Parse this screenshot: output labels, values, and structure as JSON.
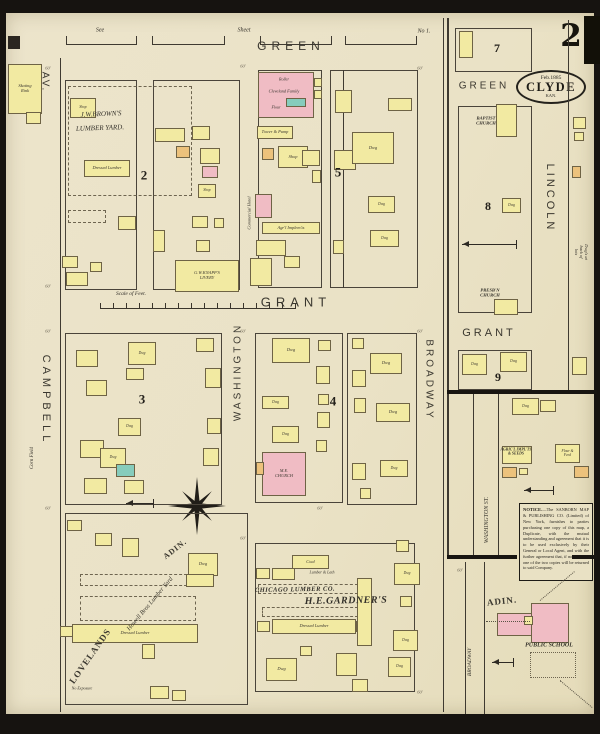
{
  "title": "Sanborn map, Clyde Kansas, Sheet 2",
  "corner": {
    "sheet_number": "2"
  },
  "stamp": {
    "date": "Feb.1885",
    "city": "CLYDE",
    "state": "KAN."
  },
  "notice": {
    "title": "NOTICE.",
    "body": "—The SANBORN MAP & PUBLISHING CO. (Limited) of New York, furnishes to parties purchasing one copy of this map, a Duplicate, with the mutual understanding and agreement that it is to be used exclusively by their General or Local Agent, and with the further agreement that, if not so used, one of the two copies will be returned to said Company."
  },
  "colors": {
    "paper": "#ebe3c8",
    "frame": "#161310",
    "line": "#3f3a31",
    "yellow": "#f2eaa2",
    "pink": "#f0bcc4",
    "teal": "#86ccbc",
    "orange": "#ecc27c",
    "mill_line": "#b86a78"
  },
  "streets": [
    {
      "t": "GREEN",
      "x": 291,
      "y": 46,
      "s": 12,
      "r": 0,
      "ls": 5,
      "f": "s"
    },
    {
      "t": "GRANT",
      "x": 296,
      "y": 302,
      "s": 13,
      "r": 0,
      "ls": 5,
      "f": "s"
    },
    {
      "t": "CAMPBELL",
      "x": 46,
      "y": 400,
      "s": 11,
      "r": 90,
      "ls": 4,
      "f": "s"
    },
    {
      "t": "AV.",
      "x": 45,
      "y": 82,
      "s": 10,
      "r": 90,
      "ls": 2,
      "f": "s"
    },
    {
      "t": "WASHINGTON",
      "x": 238,
      "y": 372,
      "s": 10,
      "r": -90,
      "ls": 3,
      "f": "s"
    },
    {
      "t": "BROADWAY",
      "x": 429,
      "y": 380,
      "s": 10,
      "r": 90,
      "ls": 3,
      "f": "s"
    },
    {
      "t": "LINCOLN",
      "x": 550,
      "y": 198,
      "s": 11,
      "r": 90,
      "ls": 3,
      "f": "s"
    },
    {
      "t": "GREEN",
      "x": 484,
      "y": 86,
      "s": 10,
      "r": 0,
      "ls": 3,
      "f": "s"
    },
    {
      "t": "GRANT",
      "x": 489,
      "y": 333,
      "s": 11,
      "r": 0,
      "ls": 3,
      "f": "s"
    },
    {
      "t": "WASHINGTON ST.",
      "x": 487,
      "y": 520,
      "s": 6,
      "r": -90,
      "ls": 0,
      "f": "i"
    },
    {
      "t": "BROADWAY",
      "x": 470,
      "y": 662,
      "s": 5.5,
      "r": -90,
      "ls": 0,
      "f": "i"
    },
    {
      "t": "ADIN.",
      "x": 175,
      "y": 549,
      "s": 8,
      "r": -38,
      "ls": 1,
      "f": "f"
    },
    {
      "t": "LOVELANDS",
      "x": 90,
      "y": 656,
      "s": 9,
      "r": -55,
      "ls": 1,
      "f": "f"
    },
    {
      "t": "ADIN.",
      "x": 502,
      "y": 601,
      "s": 9,
      "r": -6,
      "ls": 1,
      "f": "f"
    },
    {
      "t": "Howell Bros Lumber Yard",
      "x": 150,
      "y": 604,
      "s": 6.5,
      "r": -50,
      "ls": 0,
      "f": "i"
    }
  ],
  "labels": [
    {
      "t": "See",
      "x": 100,
      "y": 31,
      "s": 6,
      "st": "i",
      "r": 0
    },
    {
      "t": "Sheet",
      "x": 244,
      "y": 31,
      "s": 6,
      "st": "i",
      "r": 0
    },
    {
      "t": "No 1.",
      "x": 424,
      "y": 32,
      "s": 6,
      "st": "i",
      "r": 0
    },
    {
      "t": "J.W.BROWN'S",
      "x": 101,
      "y": 114,
      "s": 7,
      "st": "i",
      "r": -2
    },
    {
      "t": "LUMBER YARD.",
      "x": 100,
      "y": 128,
      "s": 7,
      "st": "i",
      "r": -2
    },
    {
      "t": "Scale of Feet.",
      "x": 131,
      "y": 294,
      "s": 5.5,
      "st": "i",
      "r": 0
    },
    {
      "t": "Roller",
      "x": 284,
      "y": 80,
      "s": 4,
      "st": "i",
      "r": 0
    },
    {
      "t": "Cleveland Family",
      "x": 284,
      "y": 92,
      "s": 4.3,
      "st": "i",
      "r": 0
    },
    {
      "t": "Flour",
      "x": 276,
      "y": 108,
      "s": 4,
      "st": "i",
      "r": 0
    },
    {
      "t": "Commercial Hotel",
      "x": 249,
      "y": 213,
      "s": 4.5,
      "st": "i",
      "r": -90
    },
    {
      "t": "CHICAGO LUMBER CO.",
      "x": 295,
      "y": 590,
      "s": 6.5,
      "st": "bi",
      "r": -1
    },
    {
      "t": "H.E.GARDNER'S",
      "x": 346,
      "y": 601,
      "s": 10,
      "st": "bi",
      "r": -1
    },
    {
      "t": "Lumber & Lath",
      "x": 322,
      "y": 573,
      "s": 4,
      "st": "i",
      "r": 0
    },
    {
      "t": "BAPTIST\nCHURCH",
      "x": 486,
      "y": 121,
      "s": 4.6,
      "st": "b",
      "r": 0
    },
    {
      "t": "PRESB'N\nCHURCH",
      "x": 490,
      "y": 293,
      "s": 4.6,
      "st": "b",
      "r": 0
    },
    {
      "t": "PUBLIC SCHOOL",
      "x": 549,
      "y": 646,
      "s": 6,
      "st": "b",
      "r": 0
    },
    {
      "t": "No Exposure",
      "x": 82,
      "y": 689,
      "s": 4,
      "st": "i",
      "r": 0
    },
    {
      "t": "AGRIC'L IMPL'TS\n& SEEDS",
      "x": 516,
      "y": 452,
      "s": 3.8,
      "st": "b",
      "r": 0
    },
    {
      "t": "Dwg's at back of lots",
      "x": 581,
      "y": 252,
      "s": 4.5,
      "st": "i",
      "r": 90
    },
    {
      "t": "Corn Field",
      "x": 33,
      "y": 458,
      "s": 5,
      "st": "i",
      "r": -90
    }
  ],
  "dims": {
    "t": "60'",
    "pts": [
      [
        48,
        68
      ],
      [
        243,
        66
      ],
      [
        420,
        68
      ],
      [
        48,
        286
      ],
      [
        48,
        331
      ],
      [
        243,
        331
      ],
      [
        420,
        331
      ],
      [
        48,
        508
      ],
      [
        320,
        508
      ],
      [
        460,
        570
      ],
      [
        243,
        538
      ],
      [
        420,
        692
      ]
    ]
  },
  "block_numbers": [
    {
      "t": "2",
      "x": 144,
      "y": 176,
      "s": 13
    },
    {
      "t": "5",
      "x": 338,
      "y": 173,
      "s": 13
    },
    {
      "t": "3",
      "x": 142,
      "y": 400,
      "s": 13
    },
    {
      "t": "4",
      "x": 333,
      "y": 402,
      "s": 13
    },
    {
      "t": "7",
      "x": 497,
      "y": 49,
      "s": 12
    },
    {
      "t": "8",
      "x": 488,
      "y": 207,
      "s": 12
    },
    {
      "t": "9",
      "x": 498,
      "y": 378,
      "s": 12
    }
  ],
  "blocks": [
    [
      65,
      80,
      72,
      210
    ],
    [
      153,
      80,
      87,
      210
    ],
    [
      258,
      70,
      64,
      218
    ],
    [
      330,
      70,
      88,
      218
    ],
    [
      65,
      333,
      157,
      172
    ],
    [
      255,
      333,
      88,
      170
    ],
    [
      347,
      333,
      70,
      172
    ],
    [
      65,
      513,
      183,
      192
    ],
    [
      255,
      543,
      160,
      149
    ],
    [
      455,
      28,
      77,
      44
    ],
    [
      458,
      106,
      74,
      207
    ],
    [
      458,
      350,
      74,
      40
    ]
  ],
  "lines": [
    [
      60,
      58,
      1,
      654,
      "n"
    ],
    [
      443,
      18,
      1,
      694,
      "n"
    ],
    [
      447,
      18,
      2,
      538,
      "n"
    ],
    [
      568,
      20,
      1,
      370,
      "n"
    ],
    [
      473,
      392,
      1,
      164,
      "n"
    ],
    [
      498,
      392,
      1,
      164,
      "n"
    ],
    [
      465,
      562,
      1,
      152,
      "n"
    ],
    [
      484,
      562,
      1,
      152,
      "n"
    ],
    [
      343,
      70,
      1,
      218,
      "n"
    ],
    [
      259,
      87,
      54,
      1,
      "m"
    ],
    [
      259,
      101,
      54,
      1,
      "m"
    ]
  ],
  "thick_lines": [
    [
      447,
      390,
      150,
      4
    ],
    [
      447,
      555,
      70,
      4
    ],
    [
      572,
      555,
      25,
      4
    ]
  ],
  "staples": [
    {
      "x": 66,
      "w": 69
    },
    {
      "x": 152,
      "w": 71
    },
    {
      "x": 260,
      "w": 70
    },
    {
      "x": 345,
      "w": 70
    }
  ],
  "dashed": [
    [
      68,
      86,
      124,
      110,
      "dashed"
    ],
    [
      68,
      210,
      38,
      13,
      "dashed"
    ],
    [
      80,
      574,
      112,
      12,
      "dashed"
    ],
    [
      80,
      596,
      116,
      25,
      "dashed"
    ],
    [
      258,
      584,
      100,
      10,
      "dashed"
    ],
    [
      262,
      607,
      96,
      10,
      "dashed"
    ],
    [
      530,
      652,
      46,
      26,
      "dotted"
    ]
  ],
  "buildings": [
    [
      8,
      64,
      34,
      50,
      "y",
      "Skating\nRink",
      0
    ],
    [
      26,
      112,
      15,
      12,
      "y",
      "",
      0
    ],
    [
      70,
      98,
      26,
      20,
      "y",
      "Shop",
      0
    ],
    [
      84,
      160,
      46,
      17,
      "y",
      "Dressed Lumber",
      0
    ],
    [
      118,
      216,
      18,
      14,
      "y",
      "",
      1
    ],
    [
      155,
      128,
      30,
      14,
      "y",
      "",
      0
    ],
    [
      192,
      126,
      18,
      14,
      "y",
      "",
      0
    ],
    [
      176,
      146,
      14,
      12,
      "o",
      "",
      0
    ],
    [
      200,
      148,
      20,
      16,
      "y",
      "",
      0
    ],
    [
      202,
      166,
      16,
      12,
      "p",
      "",
      0
    ],
    [
      198,
      184,
      18,
      14,
      "y",
      "Shop",
      0
    ],
    [
      153,
      230,
      12,
      22,
      "y",
      "",
      1
    ],
    [
      192,
      216,
      16,
      12,
      "y",
      "",
      0
    ],
    [
      214,
      218,
      10,
      10,
      "y",
      "",
      0
    ],
    [
      175,
      260,
      64,
      32,
      "y",
      "G.W.KNAPP'S\nLIVERY",
      1
    ],
    [
      62,
      256,
      16,
      12,
      "y",
      "",
      0
    ],
    [
      66,
      272,
      22,
      14,
      "y",
      "",
      0
    ],
    [
      90,
      262,
      12,
      10,
      "y",
      "",
      0
    ],
    [
      196,
      240,
      14,
      12,
      "y",
      "",
      0
    ],
    [
      258,
      72,
      56,
      46,
      "p",
      "",
      0
    ],
    [
      286,
      98,
      20,
      9,
      "t",
      "",
      0
    ],
    [
      314,
      78,
      8,
      9,
      "y",
      "",
      0
    ],
    [
      314,
      90,
      8,
      9,
      "y",
      "",
      0
    ],
    [
      257,
      126,
      36,
      13,
      "y",
      "Tower & Pump",
      0
    ],
    [
      278,
      146,
      30,
      22,
      "y",
      "Shop",
      0
    ],
    [
      302,
      150,
      18,
      16,
      "y",
      "",
      0
    ],
    [
      262,
      148,
      12,
      12,
      "o",
      "",
      0
    ],
    [
      255,
      194,
      17,
      24,
      "p",
      "",
      0
    ],
    [
      262,
      222,
      58,
      12,
      "y",
      "Agr'l Implem'ts",
      0
    ],
    [
      256,
      240,
      30,
      16,
      "y",
      "",
      0
    ],
    [
      250,
      258,
      22,
      28,
      "y",
      "",
      0
    ],
    [
      284,
      256,
      16,
      12,
      "y",
      "",
      0
    ],
    [
      312,
      170,
      9,
      13,
      "y",
      "",
      1
    ],
    [
      335,
      90,
      17,
      23,
      "y",
      "",
      1
    ],
    [
      334,
      150,
      22,
      20,
      "y",
      "",
      1
    ],
    [
      352,
      132,
      42,
      32,
      "y",
      "Dwg",
      0
    ],
    [
      368,
      196,
      27,
      17,
      "y",
      "Dwg",
      0
    ],
    [
      370,
      230,
      29,
      17,
      "y",
      "Dwg",
      0
    ],
    [
      388,
      98,
      24,
      13,
      "y",
      "",
      0
    ],
    [
      333,
      240,
      11,
      14,
      "y",
      "",
      0
    ],
    [
      76,
      350,
      22,
      17,
      "y",
      "",
      0
    ],
    [
      128,
      342,
      28,
      23,
      "y",
      "Dwg",
      0
    ],
    [
      126,
      368,
      18,
      12,
      "y",
      "",
      0
    ],
    [
      86,
      380,
      21,
      16,
      "y",
      "",
      0
    ],
    [
      118,
      418,
      23,
      18,
      "y",
      "Dwg",
      0
    ],
    [
      80,
      440,
      24,
      18,
      "y",
      "",
      0
    ],
    [
      100,
      448,
      26,
      20,
      "y",
      "Dwg",
      0
    ],
    [
      84,
      478,
      23,
      16,
      "y",
      "",
      0
    ],
    [
      124,
      480,
      20,
      14,
      "y",
      "",
      0
    ],
    [
      116,
      464,
      19,
      13,
      "t",
      "",
      0
    ],
    [
      205,
      368,
      16,
      20,
      "y",
      "",
      1
    ],
    [
      207,
      418,
      14,
      16,
      "y",
      "",
      1
    ],
    [
      203,
      448,
      16,
      18,
      "y",
      "",
      1
    ],
    [
      196,
      338,
      18,
      14,
      "y",
      "",
      0
    ],
    [
      272,
      338,
      38,
      25,
      "y",
      "Dwg",
      0
    ],
    [
      262,
      396,
      27,
      13,
      "y",
      "Dwg",
      0
    ],
    [
      272,
      426,
      27,
      17,
      "y",
      "Dwg",
      0
    ],
    [
      262,
      452,
      44,
      44,
      "p",
      "M.E.\nCHURCH",
      0
    ],
    [
      256,
      462,
      8,
      13,
      "o",
      "",
      0
    ],
    [
      318,
      340,
      13,
      11,
      "y",
      "",
      0
    ],
    [
      316,
      366,
      14,
      18,
      "y",
      "",
      1
    ],
    [
      318,
      394,
      11,
      11,
      "y",
      "",
      0
    ],
    [
      317,
      412,
      13,
      16,
      "y",
      "",
      1
    ],
    [
      316,
      440,
      11,
      12,
      "y",
      "",
      0
    ],
    [
      370,
      353,
      32,
      21,
      "y",
      "Dwg",
      0
    ],
    [
      376,
      403,
      34,
      19,
      "y",
      "Dwg",
      0
    ],
    [
      380,
      460,
      28,
      17,
      "y",
      "Dwg",
      0
    ],
    [
      352,
      370,
      14,
      17,
      "y",
      "",
      1
    ],
    [
      352,
      463,
      14,
      17,
      "y",
      "",
      1
    ],
    [
      354,
      398,
      12,
      15,
      "y",
      "",
      0
    ],
    [
      352,
      338,
      12,
      11,
      "y",
      "",
      0
    ],
    [
      360,
      488,
      11,
      11,
      "y",
      "",
      0
    ],
    [
      67,
      520,
      15,
      11,
      "y",
      "",
      0
    ],
    [
      95,
      533,
      17,
      13,
      "y",
      "",
      0
    ],
    [
      122,
      538,
      17,
      19,
      "y",
      "",
      1
    ],
    [
      188,
      553,
      30,
      23,
      "y",
      "Dwg",
      0
    ],
    [
      186,
      574,
      28,
      13,
      "y",
      "",
      0
    ],
    [
      72,
      624,
      126,
      19,
      "y",
      "Dressed Lumber",
      0
    ],
    [
      60,
      626,
      13,
      11,
      "y",
      "",
      0
    ],
    [
      142,
      644,
      13,
      15,
      "y",
      "",
      1
    ],
    [
      150,
      686,
      19,
      13,
      "y",
      "",
      0
    ],
    [
      172,
      690,
      14,
      11,
      "y",
      "",
      0
    ],
    [
      292,
      555,
      37,
      14,
      "y",
      "Coal",
      0
    ],
    [
      256,
      568,
      14,
      11,
      "y",
      "",
      0
    ],
    [
      272,
      568,
      23,
      12,
      "y",
      "",
      0
    ],
    [
      272,
      619,
      84,
      15,
      "y",
      "Dressed Lumber",
      0
    ],
    [
      257,
      621,
      13,
      11,
      "y",
      "",
      0
    ],
    [
      356,
      621,
      15,
      11,
      "y",
      "",
      0
    ],
    [
      357,
      578,
      15,
      68,
      "y",
      "",
      1
    ],
    [
      396,
      540,
      13,
      12,
      "y",
      "",
      0
    ],
    [
      394,
      563,
      26,
      22,
      "y",
      "Dwg",
      0
    ],
    [
      400,
      596,
      12,
      11,
      "y",
      "",
      0
    ],
    [
      393,
      630,
      25,
      21,
      "y",
      "Dwg",
      0
    ],
    [
      266,
      658,
      31,
      23,
      "y",
      "Dwg",
      0
    ],
    [
      336,
      653,
      21,
      23,
      "y",
      "",
      1
    ],
    [
      352,
      679,
      16,
      13,
      "y",
      "",
      1
    ],
    [
      388,
      657,
      23,
      20,
      "y",
      "Dwg",
      0
    ],
    [
      300,
      646,
      12,
      10,
      "y",
      "",
      0
    ],
    [
      459,
      31,
      14,
      27,
      "y",
      "",
      1
    ],
    [
      496,
      104,
      21,
      33,
      "y",
      "",
      0
    ],
    [
      502,
      198,
      19,
      15,
      "y",
      "Dwg",
      0
    ],
    [
      494,
      299,
      24,
      16,
      "y",
      "",
      0
    ],
    [
      462,
      354,
      25,
      21,
      "y",
      "Dwg",
      1
    ],
    [
      500,
      352,
      27,
      20,
      "y",
      "Dwg",
      0
    ],
    [
      572,
      357,
      15,
      18,
      "y",
      "",
      0
    ],
    [
      573,
      117,
      13,
      12,
      "y",
      "",
      0
    ],
    [
      574,
      132,
      10,
      9,
      "y",
      "",
      0
    ],
    [
      572,
      166,
      9,
      12,
      "o",
      "",
      0
    ],
    [
      512,
      398,
      27,
      17,
      "y",
      "Dwg",
      0
    ],
    [
      540,
      400,
      16,
      12,
      "y",
      "",
      0
    ],
    [
      502,
      446,
      30,
      18,
      "y",
      "",
      0
    ],
    [
      502,
      467,
      15,
      11,
      "o",
      "",
      0
    ],
    [
      555,
      444,
      25,
      19,
      "y",
      "Flour &\nFeed",
      0
    ],
    [
      574,
      466,
      15,
      12,
      "o",
      "",
      0
    ],
    [
      531,
      603,
      38,
      40,
      "p",
      "",
      0
    ],
    [
      497,
      613,
      35,
      23,
      "p",
      "",
      0
    ],
    [
      524,
      616,
      9,
      9,
      "y",
      "",
      0
    ],
    [
      519,
      468,
      9,
      7,
      "y",
      "",
      0
    ]
  ],
  "arrows": [
    [
      462,
      244,
      55
    ],
    [
      524,
      490,
      30
    ],
    [
      492,
      662,
      22
    ],
    [
      126,
      503,
      28
    ]
  ],
  "dotted_lines": [
    [
      540,
      600,
      45,
      -40
    ],
    [
      560,
      680,
      42,
      40
    ],
    [
      486,
      621,
      44,
      0
    ]
  ]
}
